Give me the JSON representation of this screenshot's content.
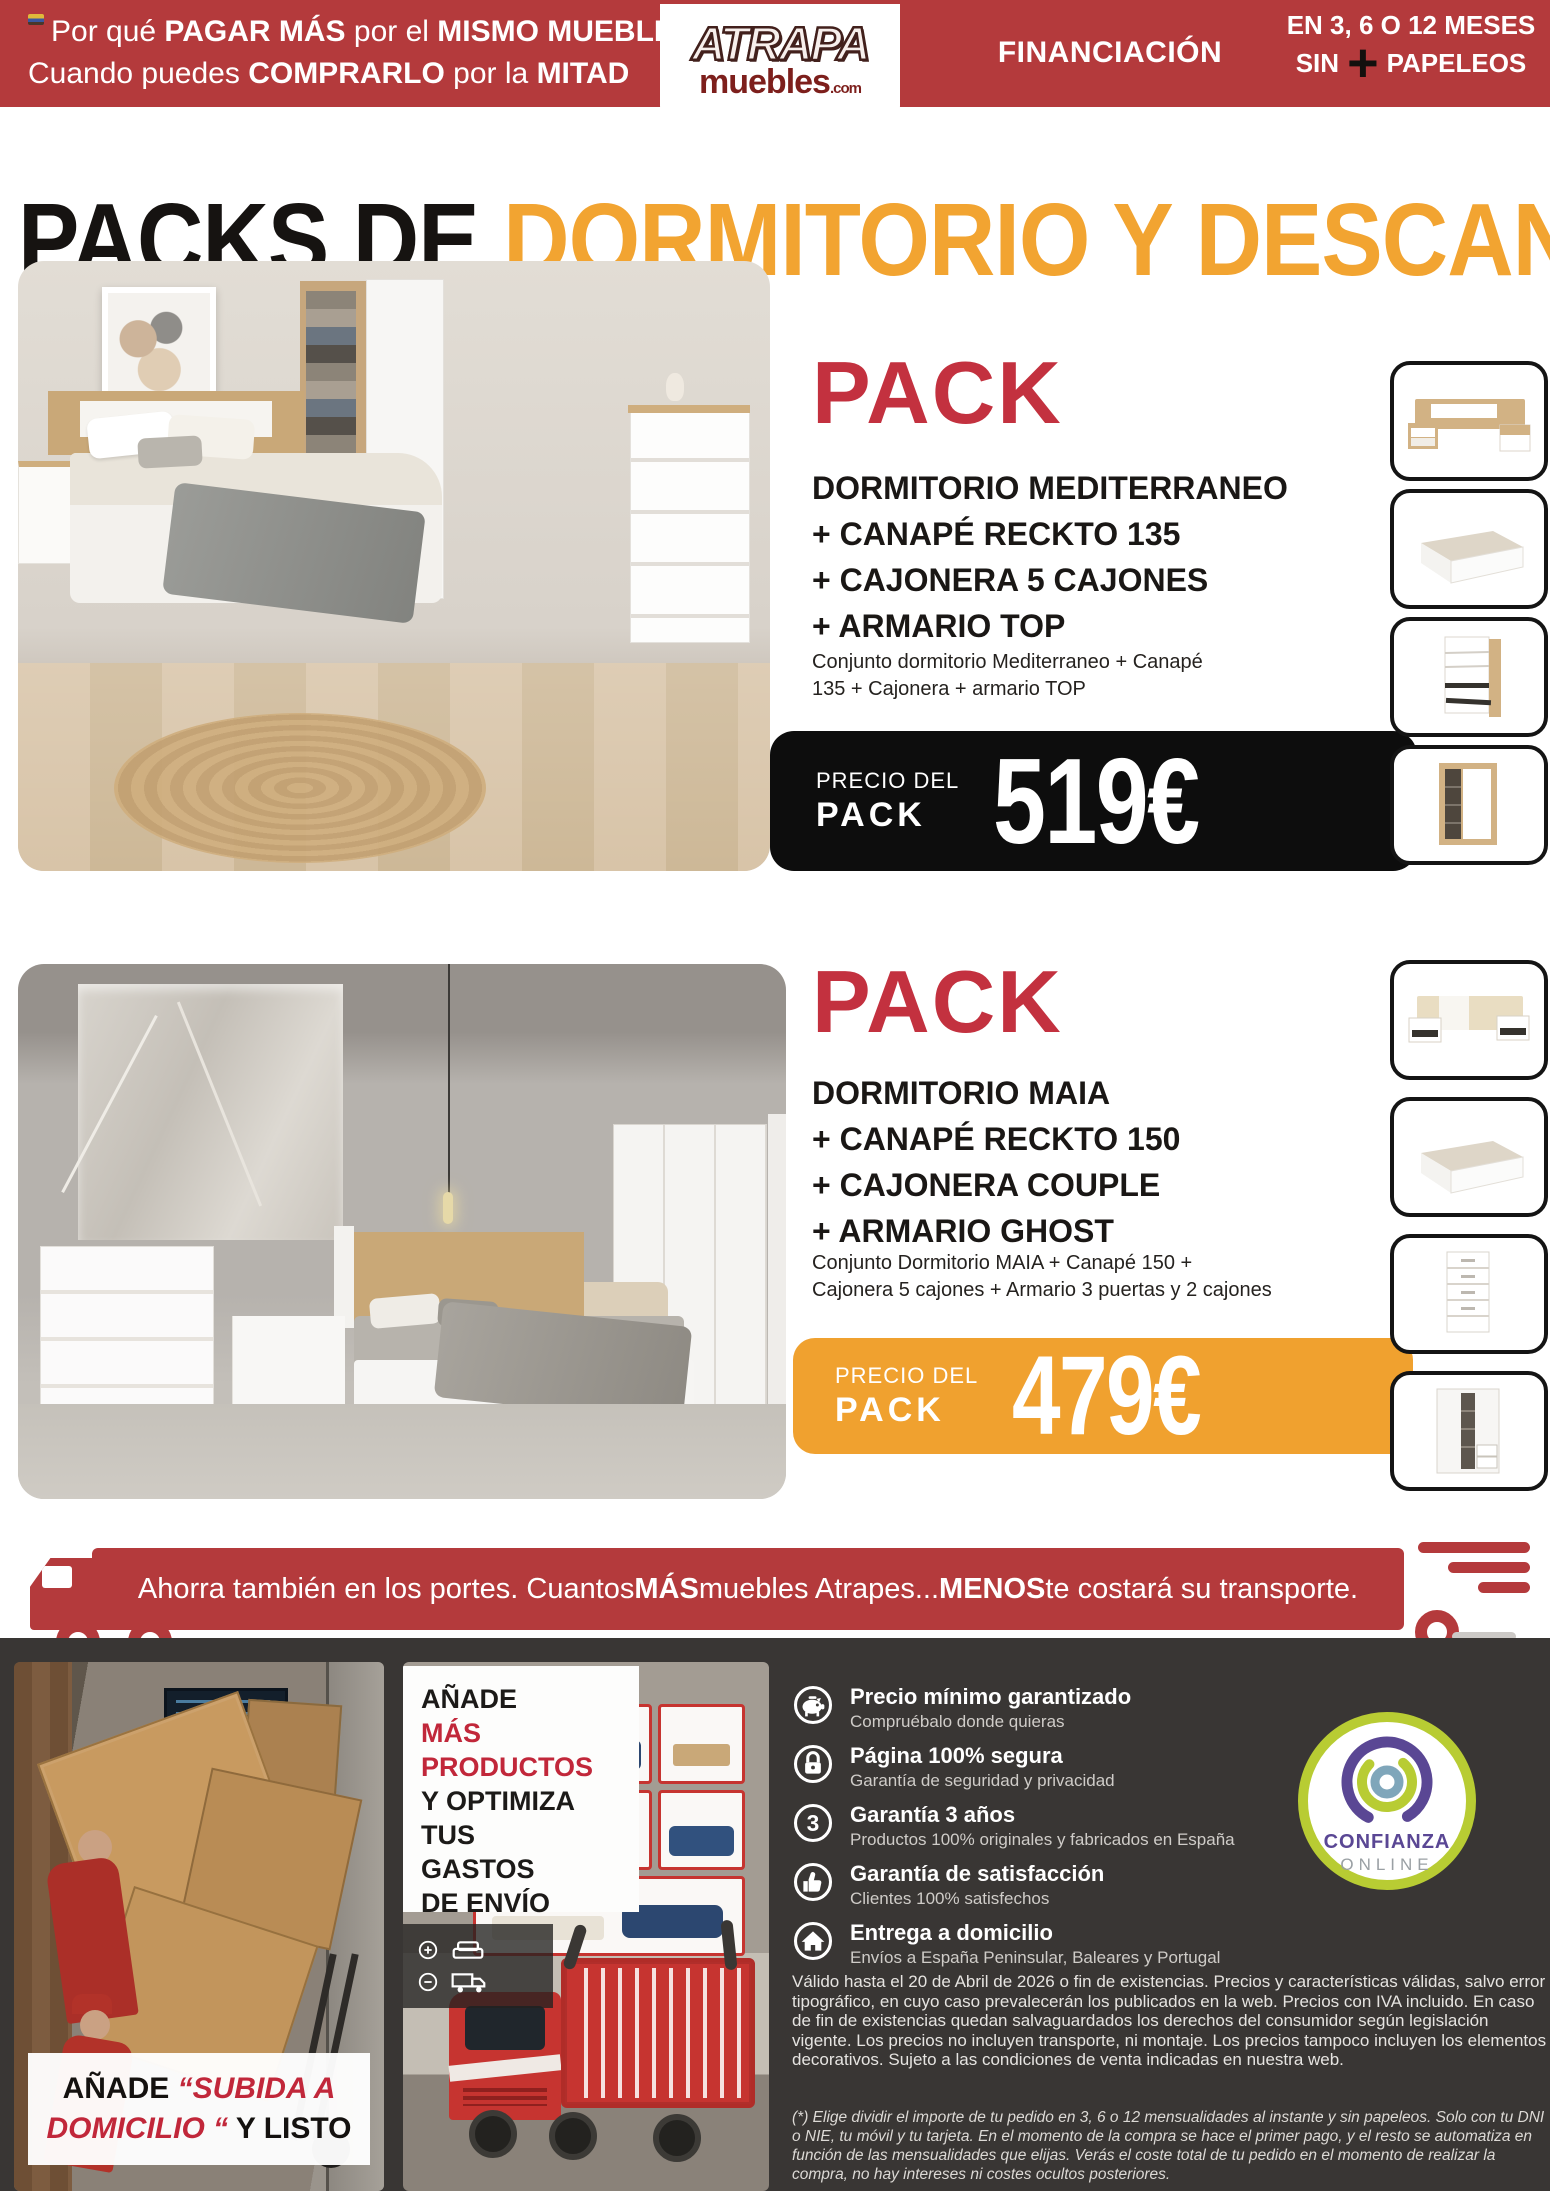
{
  "header": {
    "tagline": {
      "l1_1": "Por qué ",
      "l1_2": "PAGAR MÁS",
      "l1_3": " por el ",
      "l1_4": "MISMO MUEBLE",
      "l2_1": "Cuando puedes ",
      "l2_2": "COMPRARLO",
      "l2_3": " por la ",
      "l2_4": "MITAD"
    },
    "logo": {
      "top": "ATRAPA",
      "bottom": "muebles",
      "tld": ".com"
    },
    "financing": "FINANCIACIÓN",
    "installments": {
      "line1": "EN 3, 6 O 12 MESES",
      "sin": "SIN",
      "plus": "+",
      "papeleos": "PAPELEOS"
    }
  },
  "title": {
    "part1": "PACKS DE ",
    "part2": "DORMITORIO Y DESCANSO"
  },
  "packs": [
    {
      "label": "PACK",
      "line1": "DORMITORIO MEDITERRANEO",
      "line2": "+ CANAPÉ RECKTO 135",
      "line3": "+ CAJONERA 5 CAJONES",
      "line4": "+ ARMARIO TOP",
      "desc_line1": "Conjunto dormitorio Mediterraneo + Canapé",
      "desc_line2": "135 + Cajonera + armario TOP",
      "price_label_line1": "PRECIO DEL",
      "price_label_line2": "PACK",
      "price": "519€"
    },
    {
      "label": "PACK",
      "line1": "DORMITORIO MAIA",
      "line2": "+ CANAPÉ RECKTO 150",
      "line3": "+ CAJONERA COUPLE",
      "line4": "+ ARMARIO GHOST",
      "desc_line1": "Conjunto Dormitorio MAIA + Canapé 150 +",
      "desc_line2": "Cajonera 5 cajones + Armario 3 puertas y 2 cajones",
      "price_label_line1": "PRECIO DEL",
      "price_label_line2": "PACK",
      "price": "479€"
    }
  ],
  "shipping_banner": {
    "t1": "Ahorra también en los portes. Cuantos ",
    "t2": "MÁS",
    "t3": " muebles Atrapes... ",
    "t4": "MENOS",
    "t5": " te costará su transporte."
  },
  "footer": {
    "left_promo": {
      "p1": "AÑADE ",
      "p2": "“SUBIDA A",
      "p3": "DOMICILIO “",
      "p4": " Y LISTO"
    },
    "middle_promo": {
      "l1": "AÑADE",
      "l2": "MÁS",
      "l3": "PRODUCTOS",
      "l4": "Y OPTIMIZA",
      "l5": "TUS",
      "l6": "GASTOS",
      "l7": "DE ENVÍO"
    },
    "features": [
      {
        "icon": "piggy-bank",
        "title": "Precio mínimo garantizado",
        "subtitle": "Compruébalo donde quieras"
      },
      {
        "icon": "padlock",
        "title": "Página 100% segura",
        "subtitle": "Garantía de seguridad y privacidad"
      },
      {
        "icon": "number-3",
        "title": "Garantía 3 años",
        "subtitle": "Productos 100% originales y fabricados en España"
      },
      {
        "icon": "thumbs-up",
        "title": "Garantía de satisfacción",
        "subtitle": "Clientes 100% satisfechos"
      },
      {
        "icon": "home",
        "title": "Entrega a domicilio",
        "subtitle": "Envíos a España Peninsular, Baleares y Portugal"
      }
    ],
    "trust_badge": {
      "line1": "CONFIANZA",
      "line2": "ONLINE"
    },
    "legal": "Válido hasta el 20 de Abril de 2026 o fin de existencias. Precios y características válidas, salvo error tipográfico, en cuyo caso prevalecerán los publicados en la web. Precios con IVA incluido. En caso de fin de existencias quedan salvaguardados los derechos del consumidor según legislación vigente. Los precios no incluyen transporte, ni montaje. Los precios tampoco incluyen los elementos decorativos. Sujeto a las condiciones de venta indicadas en nuestra web.",
    "footnote": "(*) Elige dividir el importe de tu pedido en 3, 6 o 12 mensualidades al instante y sin papeleos. Solo con tu DNI o NIE, tu móvil y tu tarjeta. En el momento de la compra se hace el primer pago, y el resto se automatiza en función de las mensualidades que elijas. Verás el coste total de tu pedido en el momento de realizar la compra, no hay intereses ni costes ocultos posteriores."
  },
  "colors": {
    "header_red": "#b43a3c",
    "accent_orange": "#f0a12f",
    "pack_red": "#c3313f",
    "banner_black": "#0d0d0d",
    "footer_bg": "#393634"
  }
}
